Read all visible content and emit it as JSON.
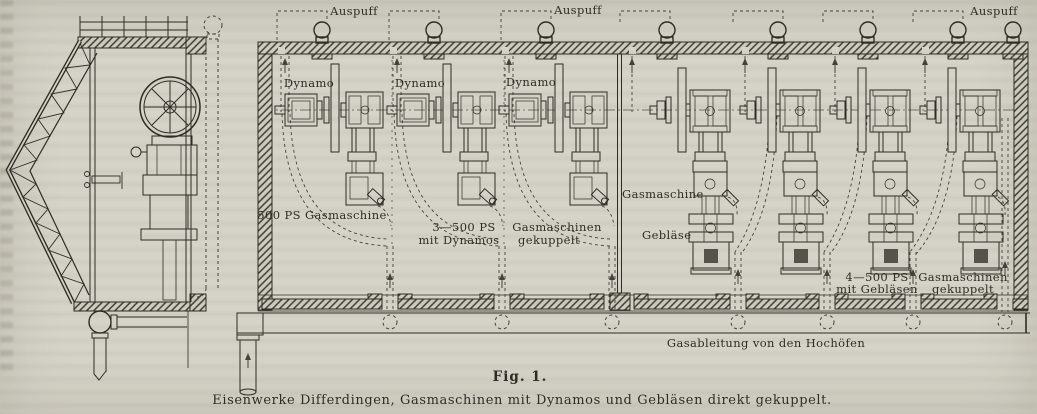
{
  "colors": {
    "paper": "#d6d3c8",
    "ink": "#2e2c24",
    "ink_light": "#55534a",
    "hatch_bg": "#cfccc0"
  },
  "figure": {
    "number": "Fig. 1.",
    "caption": "Eisenwerke Differdingen, Gasmaschinen mit Dynamos und Gebläsen direkt gekuppelt."
  },
  "plan": {
    "auspuff_labels": [
      "Auspuff",
      "Auspuff",
      "Auspuff"
    ],
    "dynamo_labels": [
      "Dynamo",
      "Dynamo",
      "Dynamo"
    ],
    "left_hall": {
      "machine_label": "500 PS Gasmaschine",
      "group_label_line1": "3—500 PS",
      "group_label_line2": "mit Dynamos",
      "coupled_label_line1": "Gasmaschinen",
      "coupled_label_line2": "gekuppelt"
    },
    "right_hall": {
      "machine_label": "Gasmaschine",
      "blower_label": "Gebläse",
      "group_label_line1": "4—500 PS",
      "group_label_line2": "mit Gebläsen",
      "coupled_label_line1": "Gasmaschinen",
      "coupled_label_line2": "gekuppelt"
    },
    "gas_main_label": "Gasableitung von den Hochöfen"
  }
}
